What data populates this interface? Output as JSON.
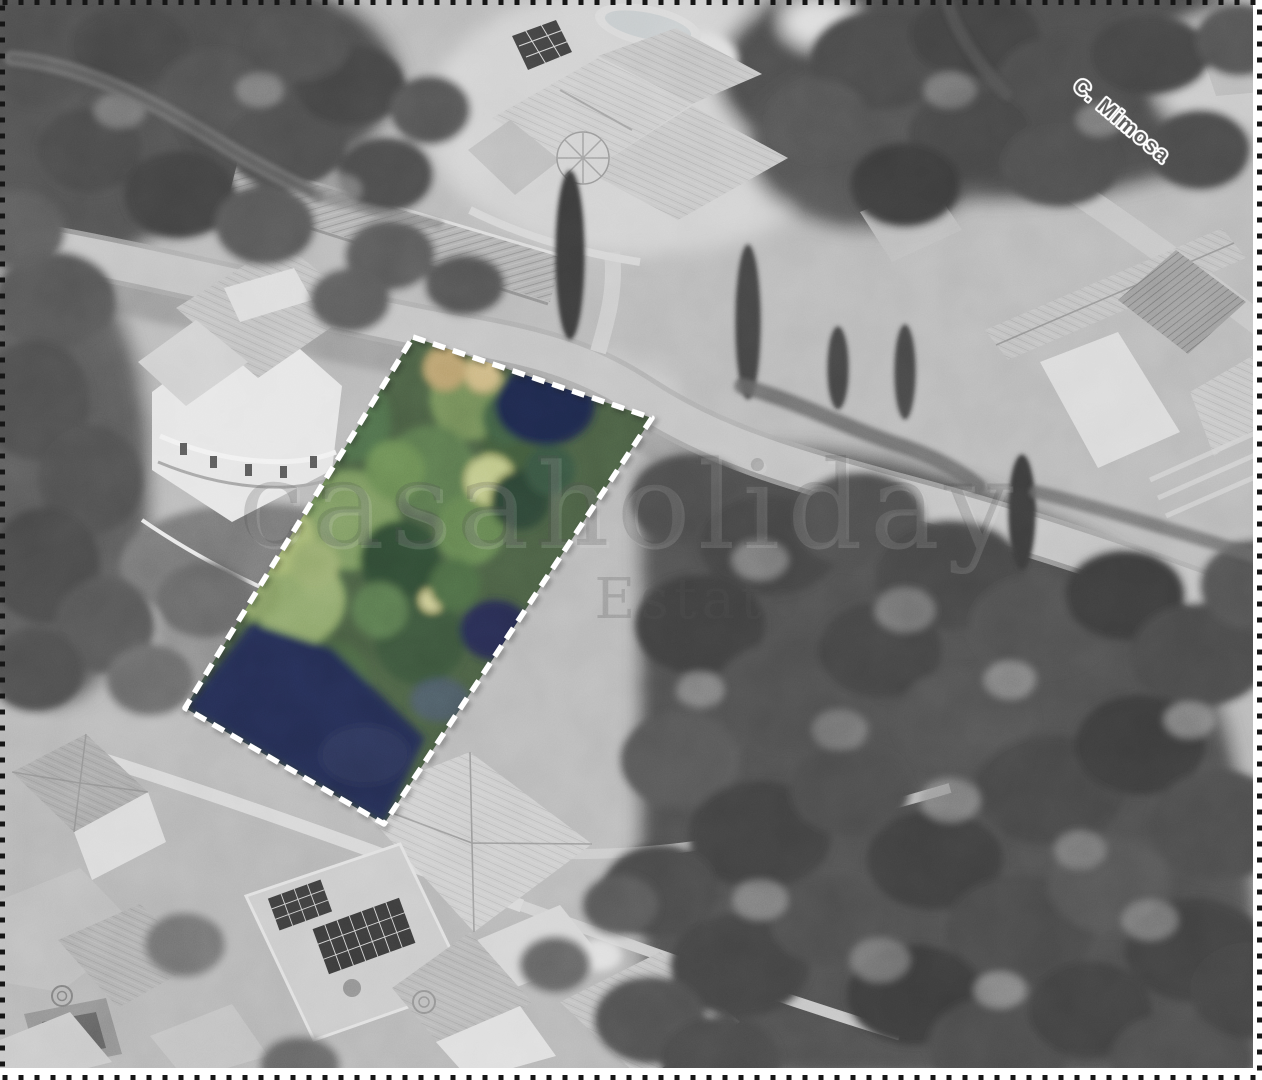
{
  "map": {
    "street_label": "C. Mimosa",
    "watermark": {
      "line1": "casaholiday",
      "line2": "Estate"
    }
  },
  "colors": {
    "photo_base": "#b4b4b4",
    "plot_vegetation_base": "#45583f",
    "plot_shadow_navy": "#232a4d",
    "plot_outline": "#ffffff",
    "border": "#161616",
    "street_label_fill": "#4f4f4f"
  }
}
